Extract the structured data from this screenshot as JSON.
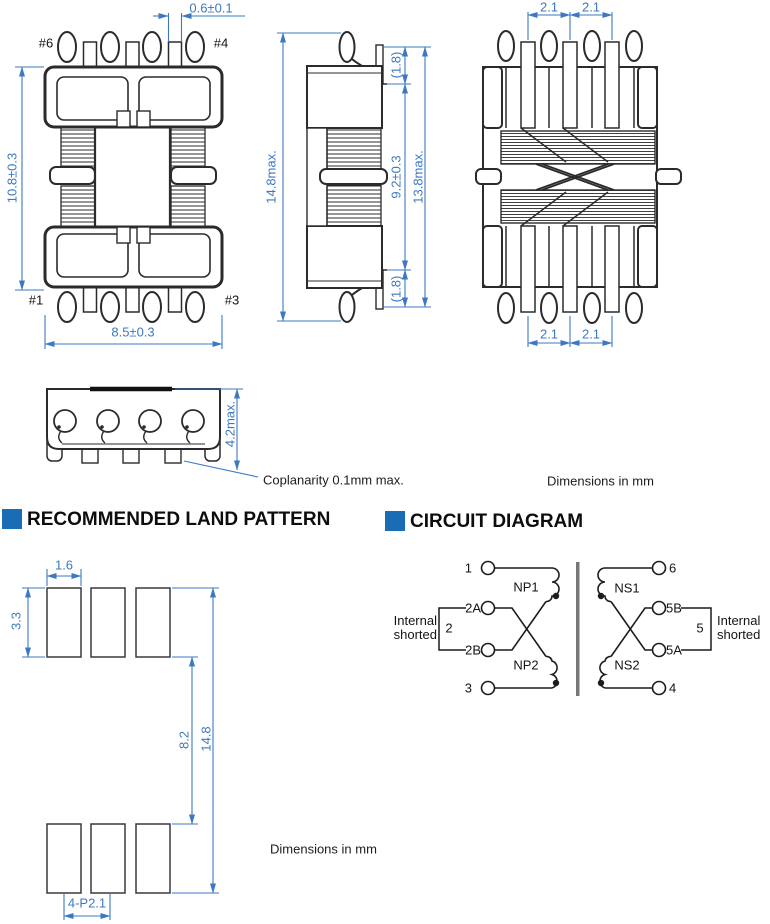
{
  "colors": {
    "dimension_blue": "#3d79c2",
    "line_dark": "#2b2b2b",
    "header_accent": "#1a6cb5"
  },
  "views": {
    "front": {
      "pin6": "#6",
      "pin4": "#4",
      "pin1": "#1",
      "pin3": "#3",
      "dim_tab": "0.6±0.1",
      "dim_height": "10.8±0.3",
      "dim_width": "8.5±0.3"
    },
    "side": {
      "dim_total_height": "14.8max.",
      "dim_lead_top": "(1.8)",
      "dim_winding": "9.2±0.3",
      "dim_lead_bottom": "(1.8)",
      "dim_body": "13.8max."
    },
    "rear": {
      "dim_pitch_a": "2.1",
      "dim_pitch_b": "2.1",
      "dim_pitch_c": "2.1",
      "dim_pitch_d": "2.1"
    },
    "bottom": {
      "dim_height": "4.2max.",
      "coplanarity": "Coplanarity 0.1mm max."
    },
    "units_note": "Dimensions in mm"
  },
  "land_pattern": {
    "title": "RECOMMENDED LAND PATTERN",
    "dim_pad_width": "1.6",
    "dim_pad_height": "3.3",
    "dim_gap": "8.2",
    "dim_total": "14.8",
    "dim_pitch": "4-P2.1",
    "units_note": "Dimensions in mm"
  },
  "circuit": {
    "title": "CIRCUIT DIAGRAM",
    "terminals": {
      "t1": "1",
      "t2a": "2A",
      "t2b": "2B",
      "t3": "3",
      "t6": "6",
      "t5b": "5B",
      "t5a": "5A",
      "t4": "4"
    },
    "windings": {
      "np1": "NP1",
      "np2": "NP2",
      "ns1": "NS1",
      "ns2": "NS2"
    },
    "shorted_left": {
      "label": "Internal shorted",
      "pin": "2"
    },
    "shorted_right": {
      "label": "Internal shorted",
      "pin": "5"
    }
  }
}
